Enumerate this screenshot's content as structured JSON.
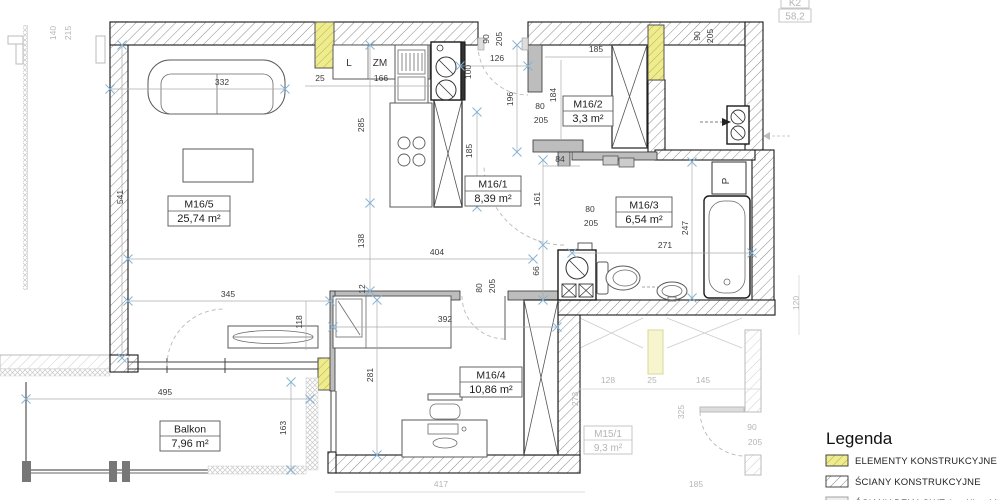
{
  "rooms": {
    "living": {
      "name": "M16/5",
      "area": "25,74 m²"
    },
    "hall": {
      "name": "M16/1",
      "area": "8,39 m²"
    },
    "wardrobe": {
      "name": "M16/2",
      "area": "3,3 m²"
    },
    "bath": {
      "name": "M16/3",
      "area": "6,54 m²"
    },
    "bedroom": {
      "name": "M16/4",
      "area": "10,86 m²"
    },
    "balcony": {
      "name": "Balkon",
      "area": "7,96 m²"
    },
    "neighbor": {
      "name": "M15/1",
      "area": "9,3 m²"
    }
  },
  "labels": {
    "fridge": "L",
    "dishwasher": "ZM",
    "washer_column": "P",
    "neighbor_unit": "K2",
    "neighbor_value": "58,2"
  },
  "dims": {
    "w541": "541",
    "s332": "332",
    "s345": "345",
    "s118": "118",
    "k25": "25",
    "k166": "166",
    "k285": "285",
    "k138": "138",
    "k12": "12",
    "h404": "404",
    "h66": "66",
    "e90": "90",
    "e205": "205",
    "e126": "126",
    "e100": "100",
    "e196": "196",
    "w80": "80",
    "w205": "205",
    "w184": "184",
    "w185": "185",
    "w84": "84",
    "h161": "161",
    "b80": "80",
    "b205": "205",
    "b247": "247",
    "b271": "271",
    "t90": "90",
    "t205": "205",
    "m80": "80",
    "m205": "205",
    "m392": "392",
    "m281": "281",
    "bal495": "495",
    "bal163": "163",
    "k185": "185"
  },
  "greydims": {
    "g140": "140",
    "g215": "215",
    "g120": "120",
    "g128": "128",
    "g25": "25",
    "g145": "145",
    "g273": "273",
    "g325": "325",
    "g90": "90",
    "g205": "205",
    "g185": "185",
    "g417": "417"
  },
  "legend": {
    "title": "Legenda",
    "items": [
      {
        "label": "ELEMENTY KONSTRUKCYJNE"
      },
      {
        "label": "ŚCIANY KONSTRUKCYJNE"
      },
      {
        "label": "ŚCIANY DZIAŁOWE (możliwość"
      }
    ]
  },
  "colors": {
    "structural_yellow": "#efec8f",
    "pale_yellow": "#f7f5cd",
    "marker_blue": "#85b4d4",
    "adjacent_grey": "#b6b6b6"
  }
}
